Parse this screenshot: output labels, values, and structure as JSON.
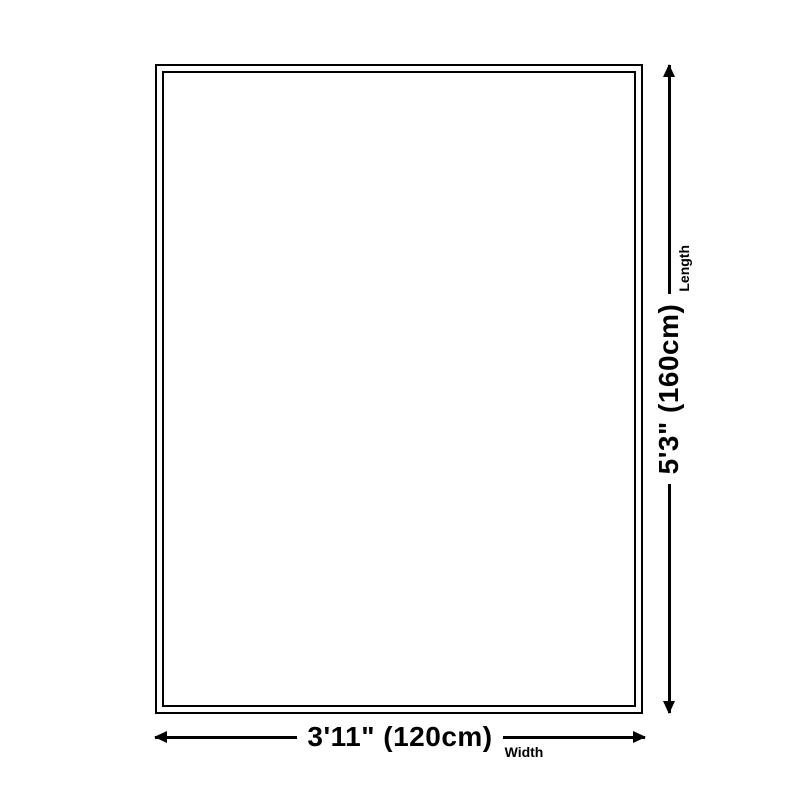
{
  "diagram": {
    "type": "product-size-dimension-diagram",
    "background_color": "#ffffff",
    "line_color": "#000000",
    "text_color": "#000000",
    "width_dim": {
      "value": "3'11\" (120cm)",
      "label": "Width"
    },
    "length_dim": {
      "value": "5'3\" (160cm)",
      "label": "Length"
    }
  }
}
